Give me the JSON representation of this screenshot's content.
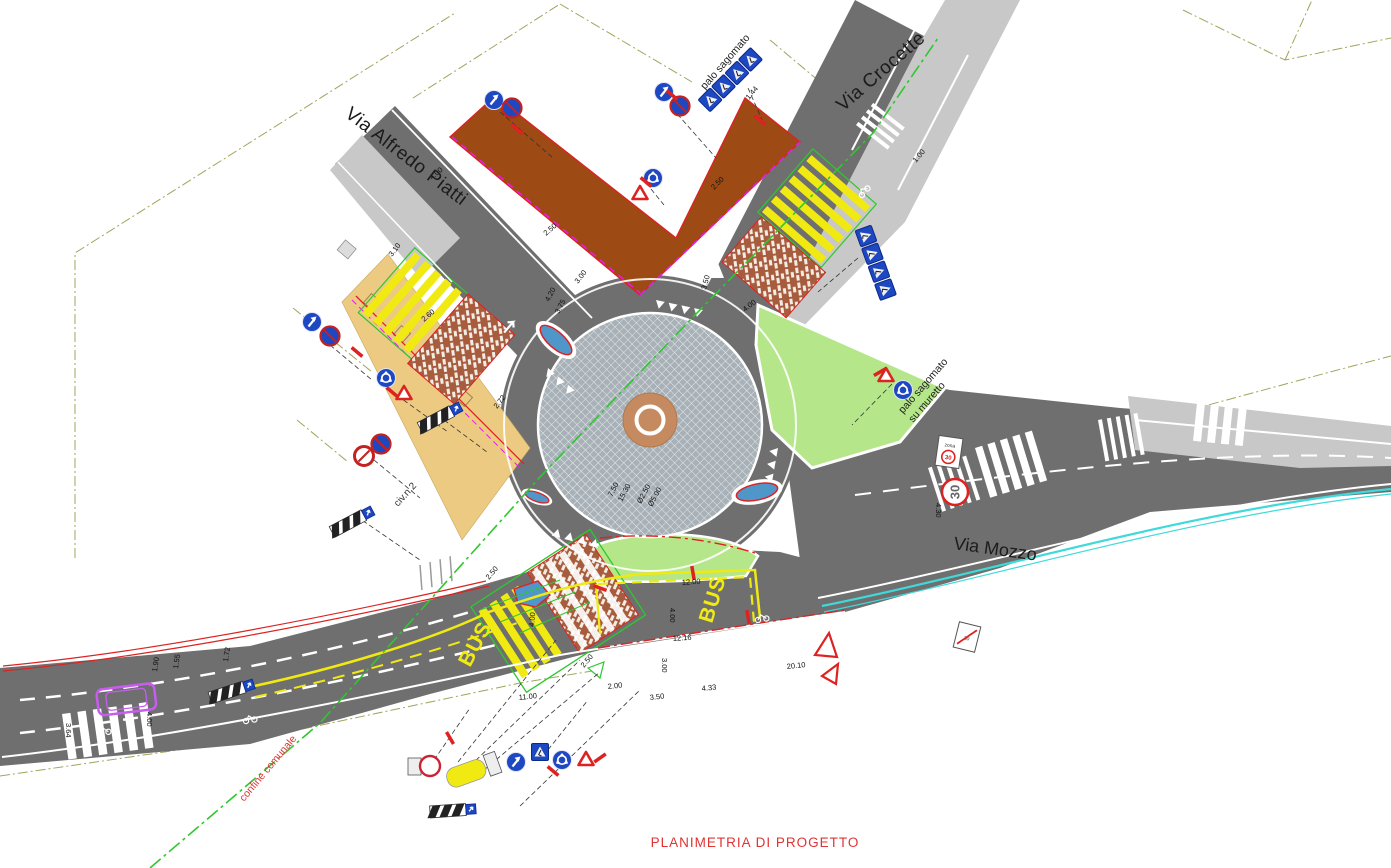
{
  "title": "PLANIMETRIA DI PROGETTO",
  "streets": {
    "piatti": "Via Alfredo Piatti",
    "crocette": "Via Crocette",
    "mozzo": "Via Mozzo"
  },
  "labels": {
    "palo_sagomato": "palo sagomato",
    "palo_muretto_1": "palo sagomato",
    "palo_muretto_2": "su muretto",
    "confine": "confine comunale",
    "civico": "civ.n.2"
  },
  "markings": {
    "bus1": "BUS",
    "bus2": "BUS",
    "speed_30": "30",
    "zona_word": "zona",
    "zona_value": "30",
    "fine_zona_value": "30"
  },
  "signs": [
    "keep-right",
    "no-stopping",
    "roundabout-ahead",
    "yield",
    "pedestrian-crossing",
    "hazard-board",
    "zona-30",
    "end-zona-30",
    "no-transit",
    "bus-stop"
  ],
  "colors": {
    "road_new": "#6f6f6f",
    "road_existing": "#c8c8c8",
    "platform_brown": "#9d4a14",
    "brick_crossing": "#a85c3e",
    "sidewalk_tan": "#ecca82",
    "green_area": "#b5e78a",
    "apron_gray": "#a8b1b7",
    "island_brown": "#c58a5f",
    "sign_blue": "#1e47c2",
    "accent_red": "#dd2222",
    "marking_yellow": "#f0ea12",
    "utility_cyan": "#3fd9d9",
    "magenta": "#e31ee3",
    "green_line": "#2ec82e",
    "boundary_khaki": "#a3a35c",
    "title_red": "#e03333"
  },
  "dims": [
    {
      "v": "4.00",
      "x": 432,
      "y": 180,
      "r": -40
    },
    {
      "v": "2.50",
      "x": 546,
      "y": 236,
      "r": -40
    },
    {
      "v": "2.50",
      "x": 714,
      "y": 190,
      "r": -45
    },
    {
      "v": "3.10",
      "x": 392,
      "y": 257,
      "r": -52
    },
    {
      "v": "2.60",
      "x": 424,
      "y": 322,
      "r": -40
    },
    {
      "v": "2.72",
      "x": 497,
      "y": 409,
      "r": -52
    },
    {
      "v": "3.00",
      "x": 578,
      "y": 284,
      "r": -52
    },
    {
      "v": "1.44",
      "x": 749,
      "y": 100,
      "r": -50
    },
    {
      "v": "3.50",
      "x": 706,
      "y": 290,
      "r": -75
    },
    {
      "v": "4.00",
      "x": 745,
      "y": 312,
      "r": -38
    },
    {
      "v": "4.20",
      "x": 549,
      "y": 302,
      "r": -62
    },
    {
      "v": "3.75",
      "x": 559,
      "y": 314,
      "r": -62
    },
    {
      "v": "1.00",
      "x": 916,
      "y": 163,
      "r": -50
    },
    {
      "v": "4.30",
      "x": 936,
      "y": 503,
      "r": 90
    },
    {
      "v": "12.00",
      "x": 682,
      "y": 585,
      "r": -4
    },
    {
      "v": "4.00",
      "x": 670,
      "y": 608,
      "r": 90
    },
    {
      "v": "12.16",
      "x": 673,
      "y": 641,
      "r": -4
    },
    {
      "v": "3.00",
      "x": 662,
      "y": 658,
      "r": 90
    },
    {
      "v": "2.00",
      "x": 608,
      "y": 689,
      "r": -6
    },
    {
      "v": "3.50",
      "x": 650,
      "y": 700,
      "r": -6
    },
    {
      "v": "4.33",
      "x": 702,
      "y": 691,
      "r": -6
    },
    {
      "v": "20.10",
      "x": 787,
      "y": 669,
      "r": -6
    },
    {
      "v": "11.00",
      "x": 519,
      "y": 700,
      "r": -6
    },
    {
      "v": "1.90",
      "x": 157,
      "y": 672,
      "r": -82
    },
    {
      "v": "1.55",
      "x": 178,
      "y": 669,
      "r": -82
    },
    {
      "v": "1.72",
      "x": 228,
      "y": 662,
      "r": -82
    },
    {
      "v": "4.00",
      "x": 147,
      "y": 712,
      "r": 90
    },
    {
      "v": "3.64",
      "x": 66,
      "y": 723,
      "r": 90
    },
    {
      "v": "7.50",
      "x": 612,
      "y": 497,
      "r": -62
    },
    {
      "v": "15.30",
      "x": 622,
      "y": 502,
      "r": -62
    },
    {
      "v": "Ø2.50",
      "x": 641,
      "y": 504,
      "r": -62
    },
    {
      "v": "Ø5.00",
      "x": 652,
      "y": 507,
      "r": -62
    },
    {
      "v": "2.50",
      "x": 489,
      "y": 580,
      "r": -50
    },
    {
      "v": "4.00",
      "x": 534,
      "y": 627,
      "r": -85
    },
    {
      "v": "2.50",
      "x": 584,
      "y": 668,
      "r": -50
    }
  ]
}
